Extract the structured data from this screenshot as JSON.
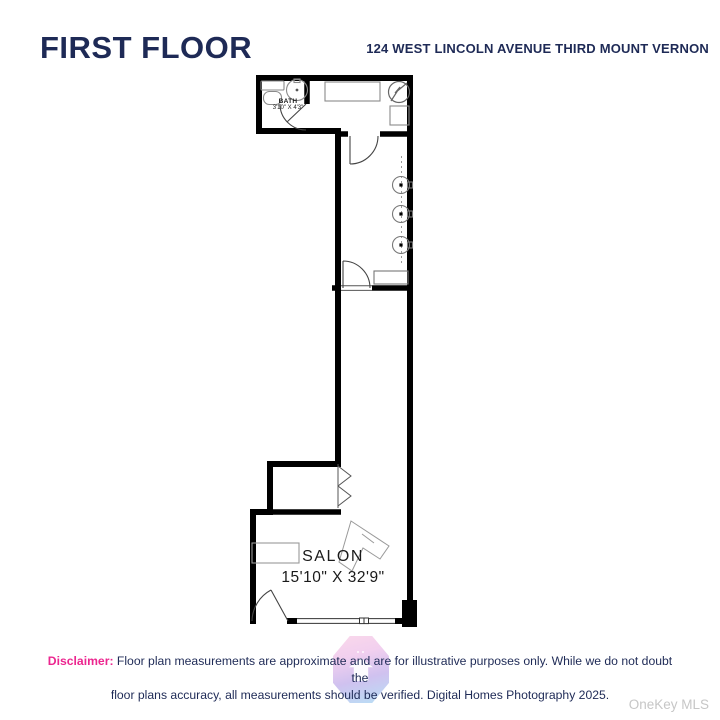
{
  "header": {
    "title": "FIRST FLOOR",
    "address": "124 WEST LINCOLN AVENUE THIRD MOUNT VERNON"
  },
  "floorplan": {
    "bath": {
      "name": "BATH",
      "dimensions": "3'10\" X 4'3\""
    },
    "salon": {
      "name": "SALON",
      "dimensions": "15'10\" X 32'9\""
    }
  },
  "footer": {
    "disclaimer_label": "Disclaimer:",
    "disclaimer_line1": "Floor plan measurements are approximate and are for illustrative purposes only. While we do not doubt the",
    "disclaimer_line2": "floor plans accuracy, all measurements should be verified. Digital Homes Photography 2025.",
    "mls_watermark": "OneKey MLS"
  },
  "colors": {
    "heading_navy": "#1e2a56",
    "disclaimer_pink": "#ec268f",
    "wall_black": "#000000",
    "fixture_gray": "#8a8a8a",
    "mls_gray": "#c6c6c6"
  }
}
